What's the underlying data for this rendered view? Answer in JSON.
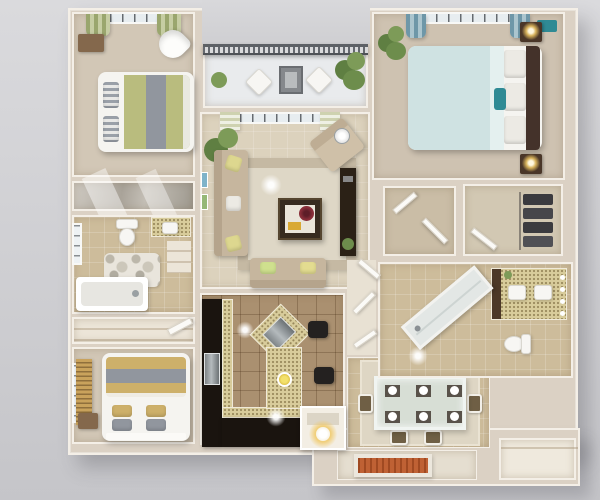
{
  "scene": {
    "kind": "top-down 3d rendered floor plan of an apartment",
    "visible_text": "none"
  },
  "palette": {
    "background_top": "#dadadd",
    "background_bottom": "#c5c5c9",
    "wall_fill": "#dbd1c4",
    "wall_edge": "#f4efe7",
    "floor_carpet": "#d2c7b6",
    "floor_tile_warm": "#cdbc9b",
    "floor_tile_kitchen": "#aa9070",
    "floor_living": "#dcd2bd",
    "balcony_floor": "#e9ebed",
    "railing": "#5d6166",
    "plant_green": "#6d8d4c",
    "cabinet_dark": "#1a140f",
    "counter_speckle": "#d8cc9b",
    "sofa_beige": "#c6b69e",
    "pillow_yellow": "#ddd78f",
    "coffee_table_dark": "#362b20",
    "bowl_red": "#8c2f3a",
    "curtain_green": "#9aa66e",
    "curtain_blue": "#6e97a8",
    "duvet_green": "#b9bc7e",
    "stripe_gray": "#91969e",
    "duvet_blue": "#cfe2e2",
    "pillow_teal": "#2f8a94",
    "headboard_dark": "#44322a",
    "lamp_gold": "#e8b84f",
    "duvet_yellow": "#cdb06a",
    "blinds_wood": "#c9a25c",
    "chair_brown": "#6f5f45",
    "mat_orange": "#bf6134"
  },
  "floorplan": {
    "rooms": [
      {
        "name": "bedroom-1",
        "position": "top-left",
        "furniture": [
          "double-bed-green-gray-striped-duvet",
          "gray-striped-pillows",
          "dresser",
          "heart-shaped-chair",
          "window-with-green-curtains"
        ]
      },
      {
        "name": "hall-closet",
        "position": "left",
        "furniture": [
          "mirrored-sliding-doors"
        ]
      },
      {
        "name": "bathroom-1",
        "position": "left",
        "furniture": [
          "toilet",
          "vanity-sink",
          "pebble-rug",
          "bathtub",
          "side-window"
        ]
      },
      {
        "name": "linen-closet",
        "position": "left",
        "furniture": [
          "shelves"
        ]
      },
      {
        "name": "bedroom-2",
        "position": "bottom-left",
        "furniture": [
          "double-bed-yellow-gray-striped-duvet",
          "yellow-and-gray-pillows",
          "nightstand",
          "window-with-wood-blinds"
        ]
      },
      {
        "name": "balcony",
        "position": "top-center",
        "furniture": [
          "gray-railing",
          "two-white-chairs",
          "outdoor-table",
          "potted-plants"
        ]
      },
      {
        "name": "living-room",
        "position": "center",
        "furniture": [
          "l-shaped-beige-sofa",
          "loveseat",
          "accent-armchair",
          "dark-coffee-table-with-red-bowl",
          "area-rug",
          "media-console",
          "floor-lamp",
          "tall-plant",
          "wall-art",
          "window-with-patterned-curtains"
        ]
      },
      {
        "name": "kitchen",
        "position": "center-bottom",
        "furniture": [
          "dark-l-shaped-cabinets",
          "speckled-countertop",
          "stainless-appliance",
          "angled-island-with-cooktop",
          "two-bar-stools",
          "tile-floor"
        ]
      },
      {
        "name": "dining-area",
        "position": "bottom-right-of-kitchen",
        "furniture": [
          "glass-dining-table",
          "six-brown-chairs",
          "six-place-settings",
          "area-rug"
        ]
      },
      {
        "name": "entry",
        "position": "bottom",
        "furniture": [
          "console-table-with-glowing-lamp",
          "orange-door-mat"
        ]
      },
      {
        "name": "master-bedroom",
        "position": "top-right",
        "furniture": [
          "king-bed-light-blue-duvet",
          "teal-accent-pillow",
          "dark-headboard",
          "two-nightstands-with-gold-lamps",
          "window-with-blue-curtains",
          "plant",
          "teal-rug"
        ]
      },
      {
        "name": "walk-in-closet-a",
        "position": "right-middle",
        "furniture": [
          "open-door"
        ]
      },
      {
        "name": "walk-in-closet-b",
        "position": "right-middle",
        "furniture": [
          "hanging-dark-clothes",
          "closet-rod"
        ]
      },
      {
        "name": "master-bathroom",
        "position": "right",
        "furniture": [
          "double-sink-vanity",
          "vanity-lights",
          "diagonal-shower-tub",
          "toilet"
        ]
      },
      {
        "name": "storage-closet",
        "position": "bottom-right",
        "furniture": []
      }
    ]
  }
}
